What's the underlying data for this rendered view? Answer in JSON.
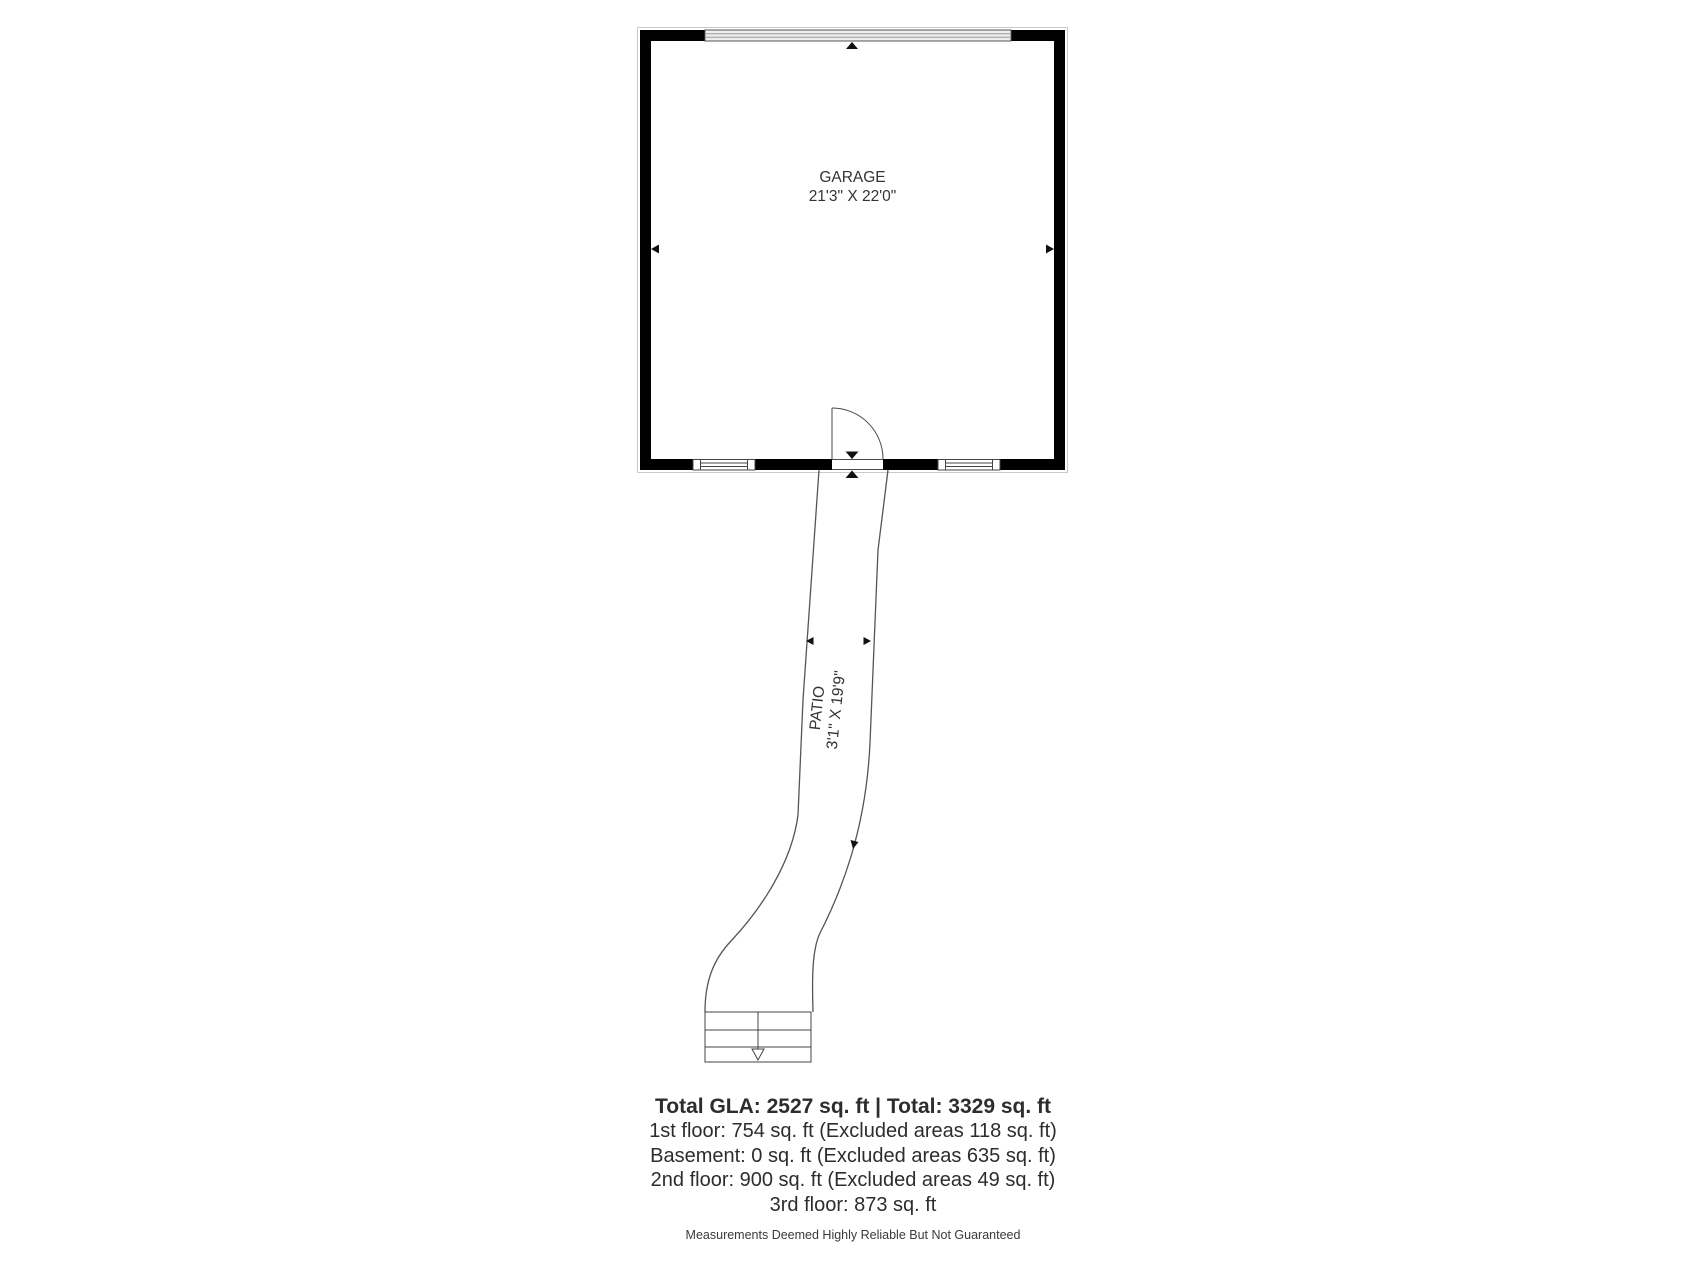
{
  "floorplan": {
    "garage": {
      "name": "GARAGE",
      "dims": "21'3\" X 22'0\""
    },
    "patio": {
      "name": "PATIO",
      "dims": "3'1\" X 19'9\""
    }
  },
  "summary": {
    "total": "Total GLA: 2527 sq. ft | Total: 3329 sq. ft",
    "floors": [
      "1st floor: 754 sq. ft (Excluded areas 118 sq. ft)",
      "Basement: 0 sq. ft (Excluded areas 635 sq. ft)",
      "2nd floor: 900 sq. ft (Excluded areas 49 sq. ft)",
      "3rd floor: 873 sq. ft"
    ],
    "disclaimer": "Measurements Deemed Highly Reliable But Not Guaranteed"
  },
  "colors": {
    "wall": "#000000",
    "thin_line": "#4a4a4a",
    "patio_line": "#555555",
    "outline": "#c9c9c9",
    "garage_door_fill": "#ededed",
    "garage_door_stripe": "#999999",
    "text": "#333333"
  }
}
